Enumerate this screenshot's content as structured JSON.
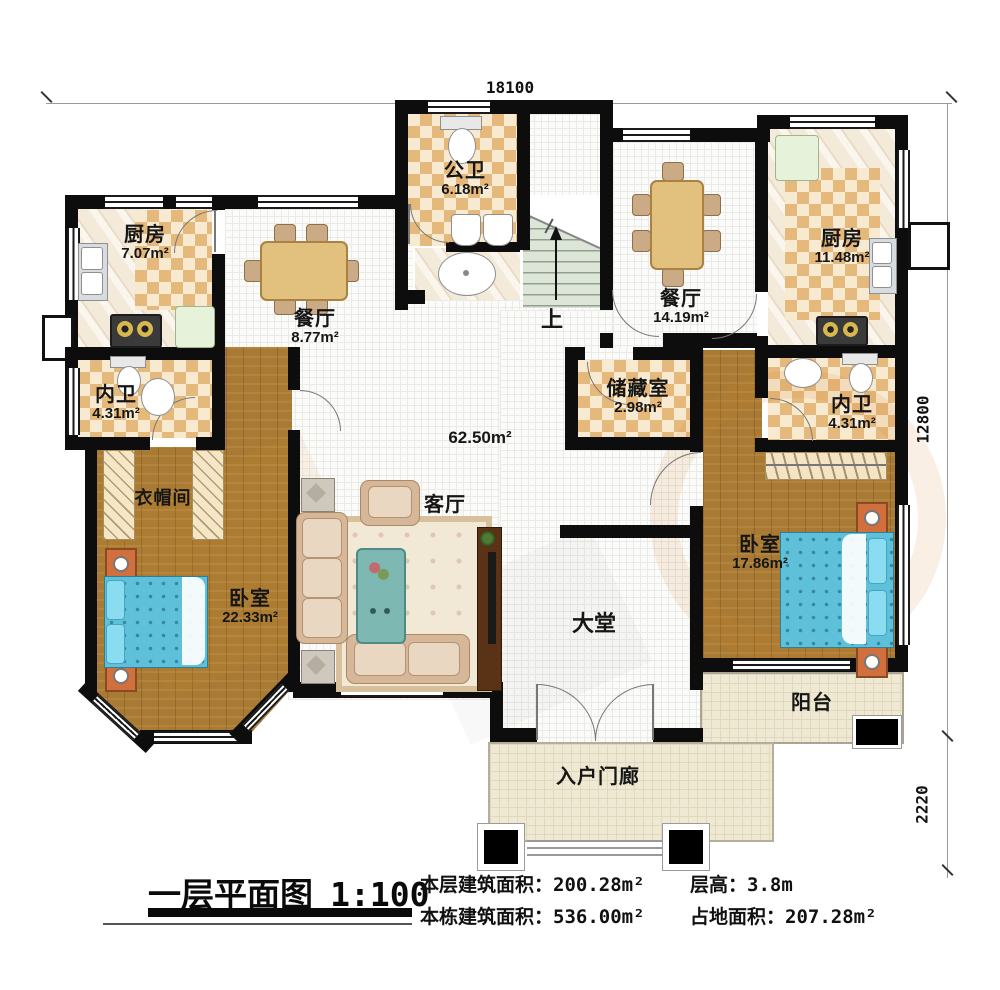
{
  "palette": {
    "wall": "#0d0d0d",
    "checker_dark": "#e5b87c",
    "checker_light": "#f7ead0",
    "wood_floor": "#a87a33",
    "bed_blue": "#5fc0d9",
    "grid_floor": "#fbfbfa",
    "balcony_cream": "#efe9d3",
    "stairs_green": "#dde5d8",
    "watermark_orange": "#d4822d"
  },
  "dimensions": {
    "top": "18100",
    "right_upper": "12800",
    "right_lower": "2220"
  },
  "rooms": {
    "public_bath": {
      "name": "公卫",
      "area": "6.18m²"
    },
    "kitchen_left": {
      "name": "厨房",
      "area": "7.07m²"
    },
    "dining_left": {
      "name": "餐厅",
      "area": "8.77m²"
    },
    "dining_right": {
      "name": "餐厅",
      "area": "14.19m²"
    },
    "kitchen_right": {
      "name": "厨房",
      "area": "11.48m²"
    },
    "bath_left": {
      "name": "内卫",
      "area": "4.31m²"
    },
    "bath_right": {
      "name": "内卫",
      "area": "4.31m²"
    },
    "storage": {
      "name": "储藏室",
      "area": "2.98m²"
    },
    "cloakroom": {
      "name": "衣帽间"
    },
    "bedroom_left": {
      "name": "卧室",
      "area": "22.33m²"
    },
    "bedroom_right": {
      "name": "卧室",
      "area": "17.86m²"
    },
    "living": {
      "name": "客厅",
      "area": "62.50m²"
    },
    "hall": {
      "name": "大堂"
    },
    "balcony": {
      "name": "阳台"
    },
    "porch": {
      "name": "入户门廊"
    },
    "stairs": {
      "up_label": "上"
    }
  },
  "title": {
    "name": "一层平面图",
    "scale": "1:100"
  },
  "stats": [
    {
      "label": "本层建筑面积：",
      "value": "200.28m²"
    },
    {
      "label": "本栋建筑面积：",
      "value": "536.00m²"
    },
    {
      "label": "层高：",
      "value": "3.8m"
    },
    {
      "label": "占地面积：",
      "value": "207.28m²"
    }
  ]
}
